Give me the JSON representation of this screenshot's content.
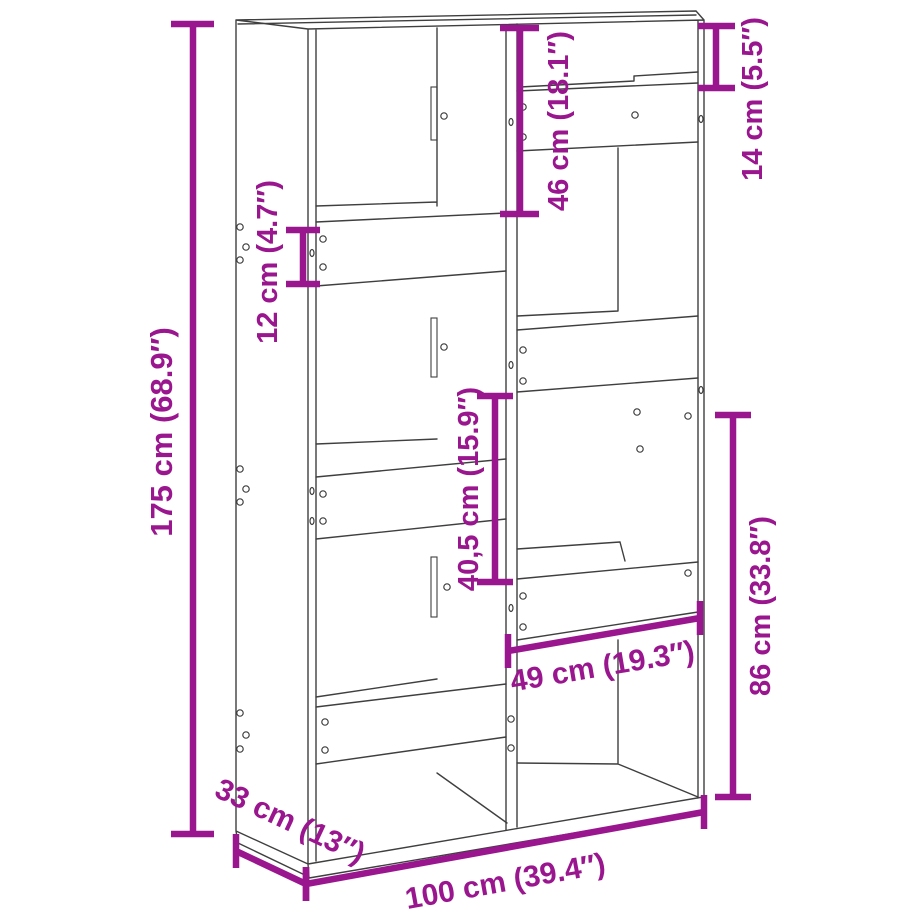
{
  "diagram": {
    "title": "Bookcase room divider dimension diagram",
    "colors": {
      "outline": "#3f3f3f",
      "dimension": "#9a168f",
      "background": "#ffffff"
    },
    "dimensions": {
      "height": {
        "label": "175 cm (68.9″)",
        "value_cm": "175",
        "value_in": "68.9"
      },
      "width": {
        "label": "100 cm (39.4″)",
        "value_cm": "100",
        "value_in": "39.4"
      },
      "depth": {
        "label": "33 cm (13″)",
        "value_cm": "33",
        "value_in": "13"
      },
      "top_left_compartment_height": {
        "label": "46 cm (18.1″)",
        "value_cm": "46",
        "value_in": "18.1"
      },
      "shelf_band_height": {
        "label": "12 cm (4.7″)",
        "value_cm": "12",
        "value_in": "4.7"
      },
      "top_right_opening_height": {
        "label": "14 cm (5.5″)",
        "value_cm": "14",
        "value_in": "5.5"
      },
      "middle_right_compartment_height": {
        "label": "40,5 cm (15.9″)",
        "value_cm": "40,5",
        "value_in": "15.9"
      },
      "right_compartment_width": {
        "label": "49 cm (19.3″)",
        "value_cm": "49",
        "value_in": "19.3"
      },
      "lower_right_section_height": {
        "label": "86 cm (33.8″)",
        "value_cm": "86",
        "value_in": "33.8"
      }
    }
  }
}
